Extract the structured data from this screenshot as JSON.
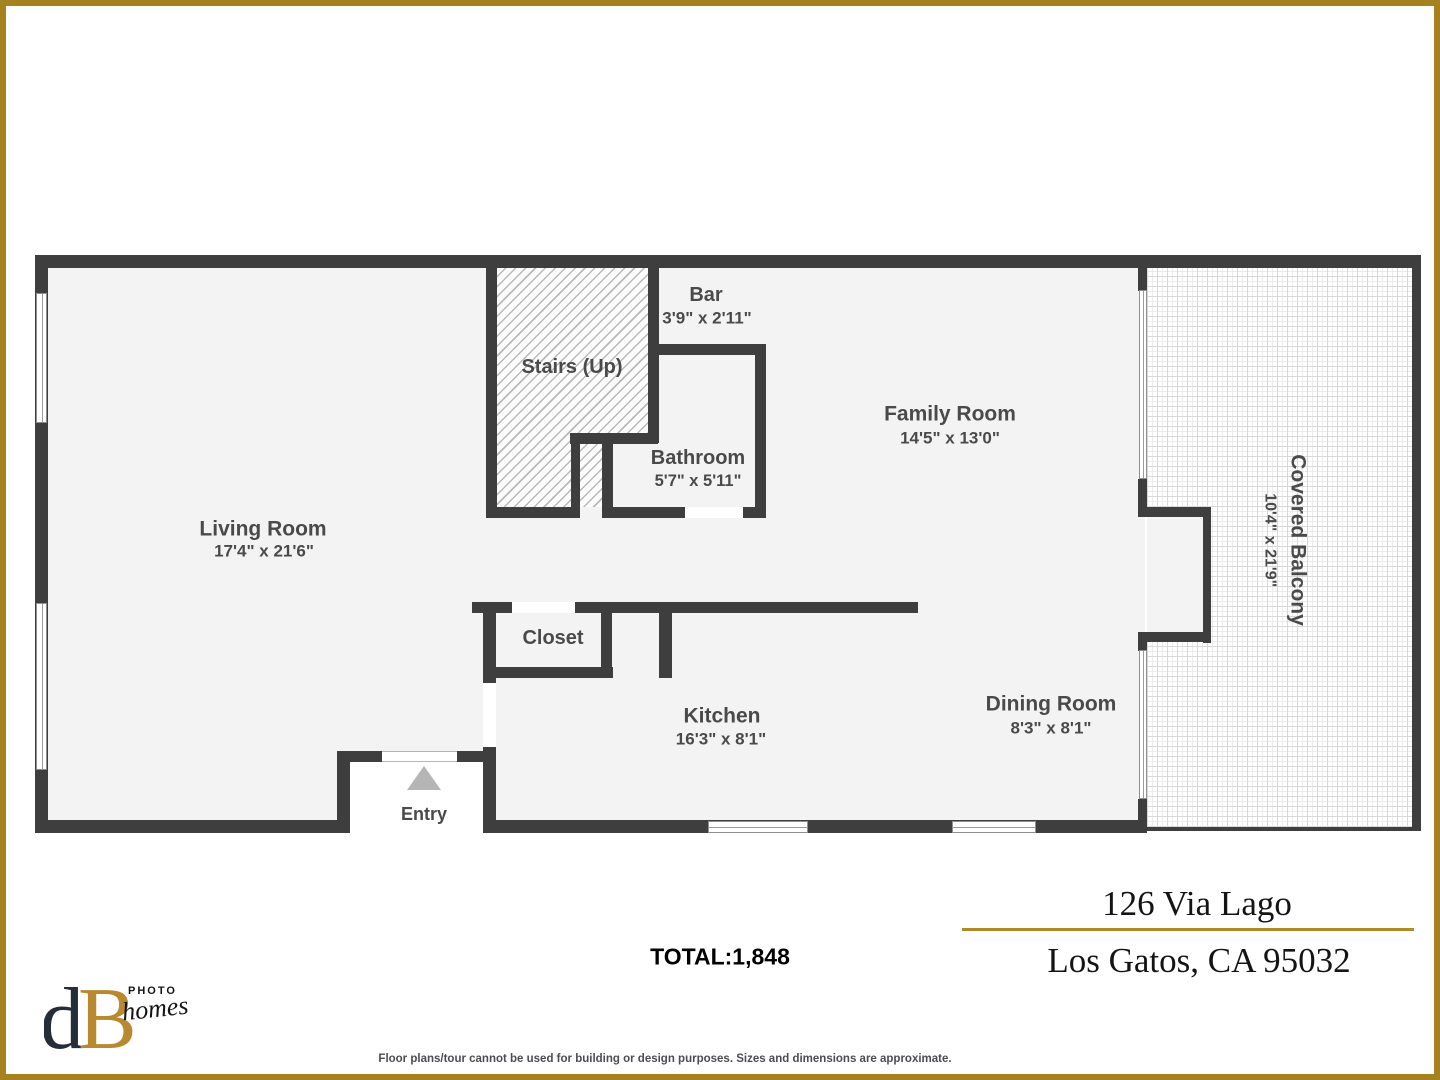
{
  "rooms": {
    "living": {
      "name": "Living Room",
      "dims": "17'4\" x 21'6\""
    },
    "stairs": {
      "name": "Stairs (Up)"
    },
    "bar": {
      "name": "Bar",
      "dims": "3'9\" x 2'11\""
    },
    "bathroom": {
      "name": "Bathroom",
      "dims": "5'7\" x 5'11\""
    },
    "family": {
      "name": "Family Room",
      "dims": "14'5\" x 13'0\""
    },
    "closet": {
      "name": "Closet"
    },
    "kitchen": {
      "name": "Kitchen",
      "dims": "16'3\" x 8'1\""
    },
    "dining": {
      "name": "Dining Room",
      "dims": "8'3\" x 8'1\""
    },
    "balcony": {
      "name": "Covered Balcony",
      "dims": "10'4\" x 21'9\""
    },
    "entry": {
      "name": "Entry"
    }
  },
  "summary": {
    "total_label": "TOTAL:1,848"
  },
  "address": {
    "line1": "126 Via Lago",
    "line2": "Los Gatos, CA 95032"
  },
  "branding": {
    "monogram_d": "d",
    "monogram_b": "B",
    "word_photo": "PHOTO",
    "word_homes": "homes"
  },
  "disclaimer": "Floor plans/tour cannot be used for building or design purposes. Sizes and dimensions are approximate.",
  "colors": {
    "wall": "#3e3e3e",
    "floor": "#f3f3f3",
    "border_gold": "#a5811f",
    "label": "#4a4a4a"
  }
}
